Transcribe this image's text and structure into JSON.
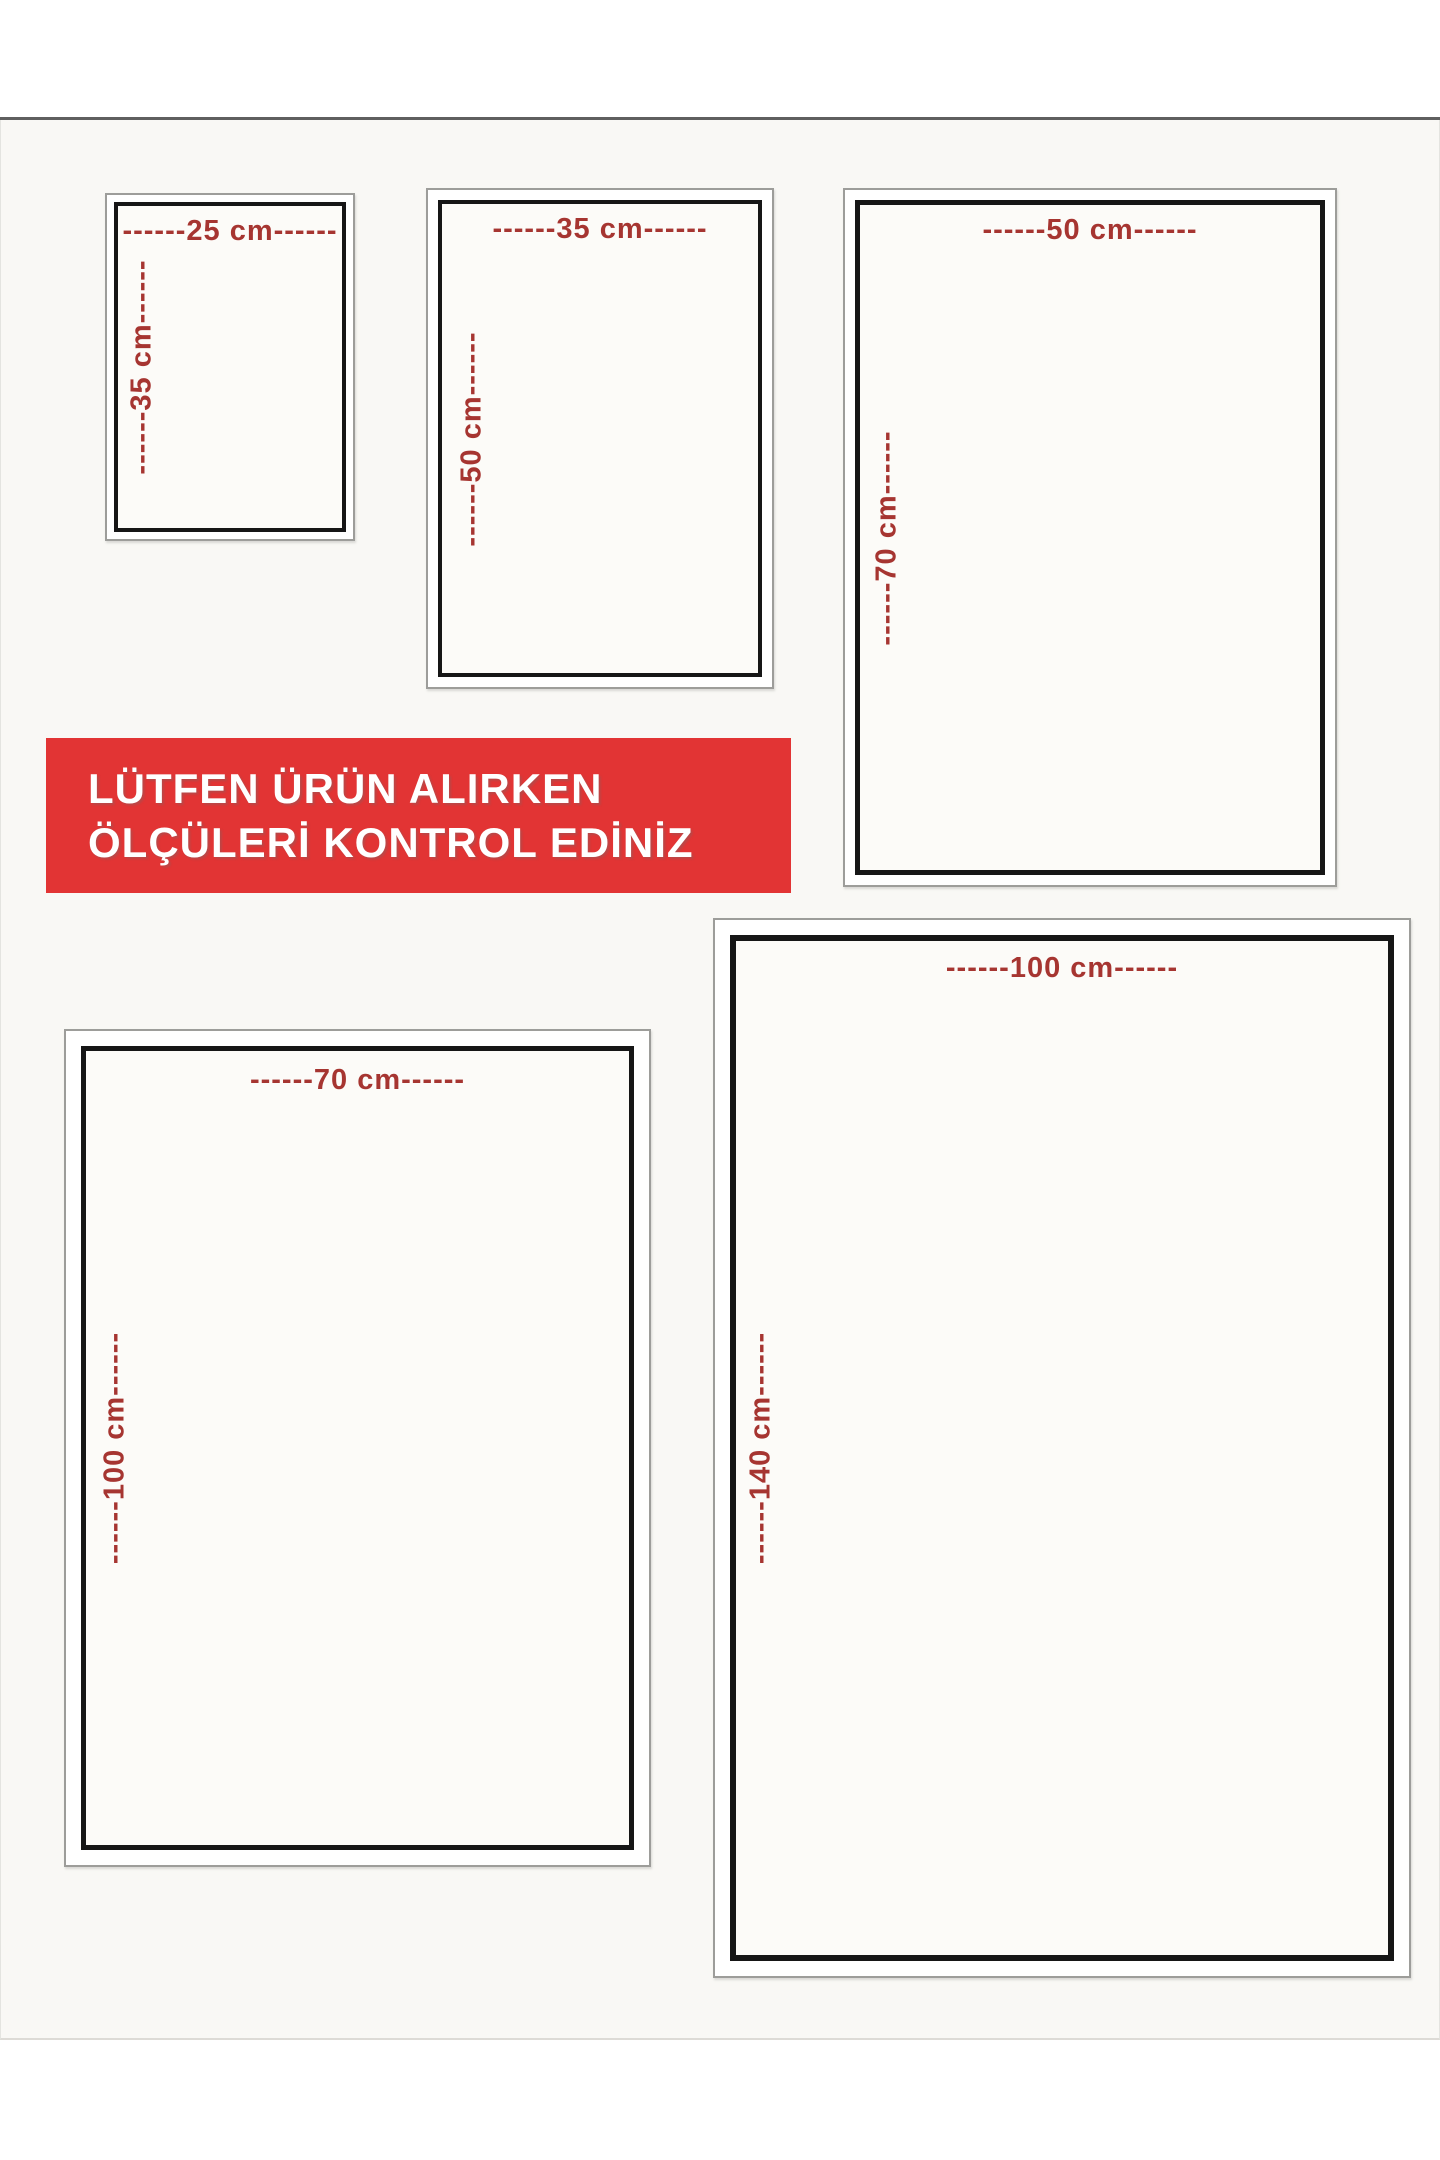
{
  "banner": {
    "line1": "LÜTFEN ÜRÜN ALIRKEN",
    "line2": "ÖLÇÜLERİ KONTROL EDİNİZ",
    "background": "#e23434",
    "text_color": "#ffffff"
  },
  "label_color": "#a63531",
  "sizes": [
    {
      "id": "25x35",
      "width_label": "------25 cm------",
      "height_label": "------35 cm------"
    },
    {
      "id": "35x50",
      "width_label": "------35 cm------",
      "height_label": "------50 cm------"
    },
    {
      "id": "50x70",
      "width_label": "------50 cm------",
      "height_label": "------70 cm------"
    },
    {
      "id": "70x100",
      "width_label": "------70 cm------",
      "height_label": "------100 cm------"
    },
    {
      "id": "100x140",
      "width_label": "------100 cm------",
      "height_label": "------140 cm------"
    }
  ]
}
